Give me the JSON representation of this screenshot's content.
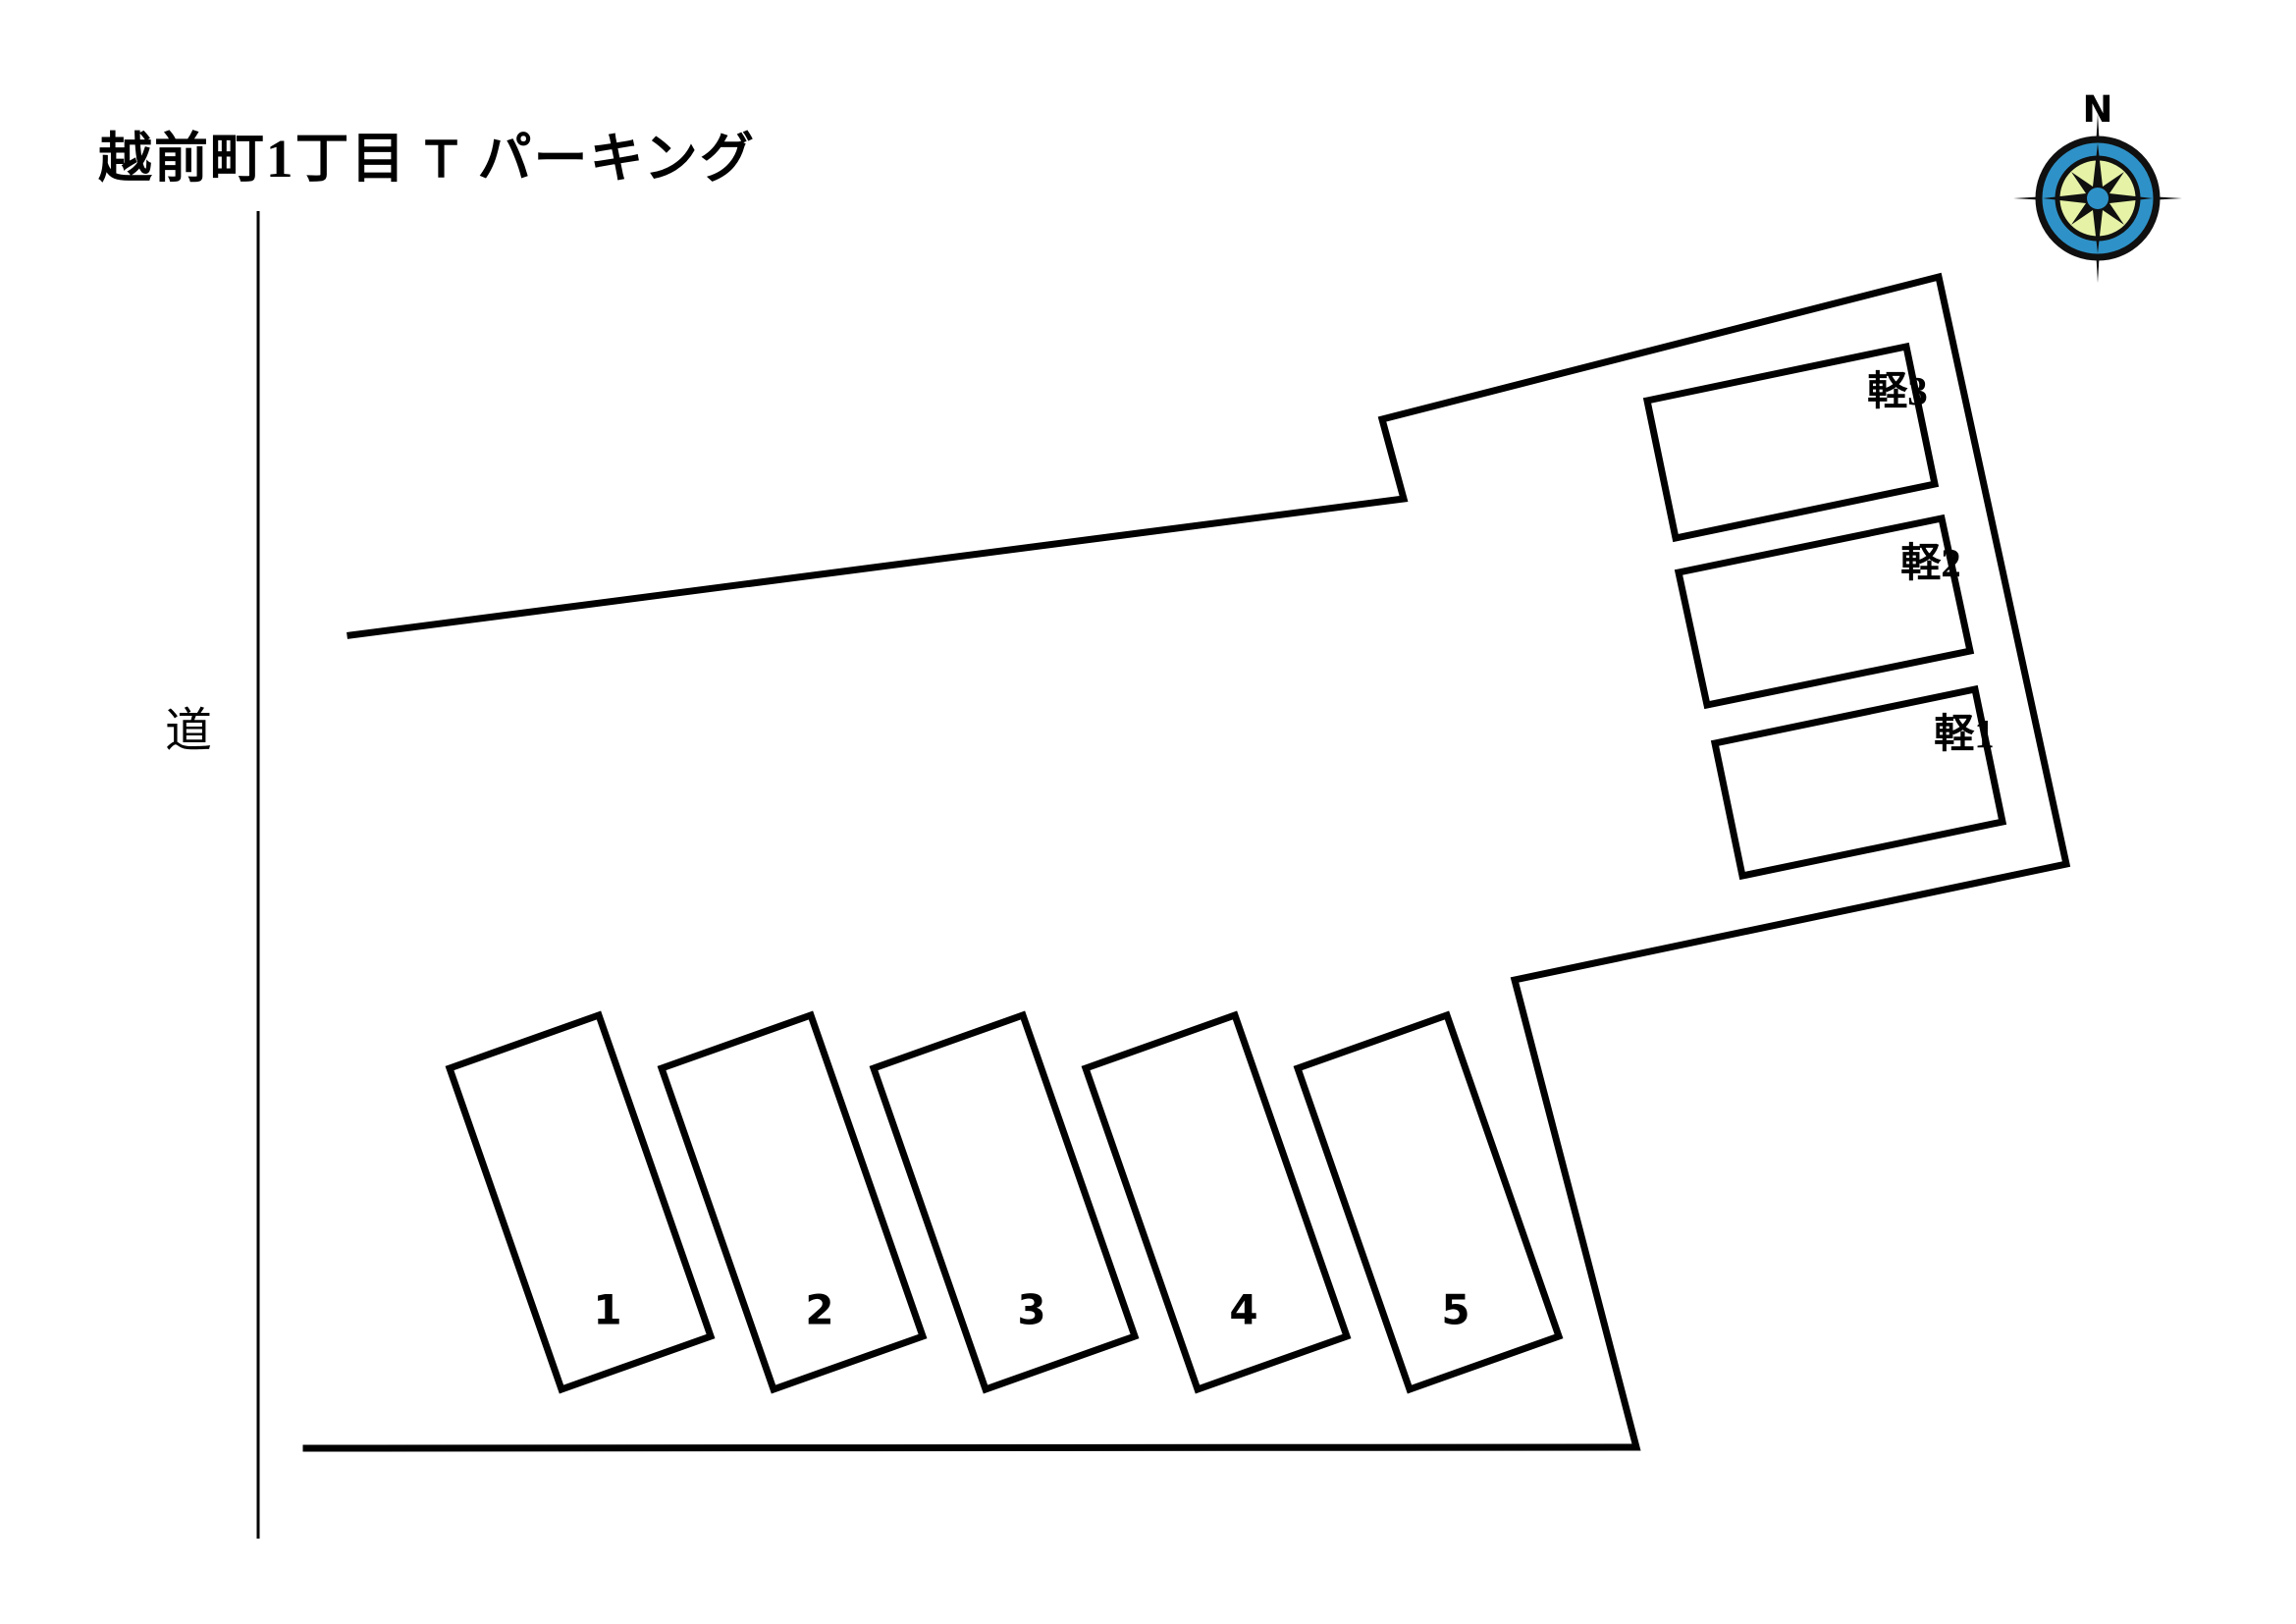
{
  "title": {
    "prefix": "越前町1丁目",
    "t_mark": "Ｔ",
    "suffix": "パーキング"
  },
  "road_label": "道",
  "compass": {
    "north_label": "N",
    "ring_color": "#2e92c8",
    "face_color": "#e6f2a6",
    "needle_color": "#101010",
    "center_dot_color": "#2e92c8"
  },
  "lot": {
    "spaces": [
      {
        "label": "1"
      },
      {
        "label": "2"
      },
      {
        "label": "3"
      },
      {
        "label": "4"
      },
      {
        "label": "5"
      }
    ],
    "kei_spaces": [
      {
        "label": "軽3"
      },
      {
        "label": "軽2"
      },
      {
        "label": "軽1"
      }
    ]
  }
}
